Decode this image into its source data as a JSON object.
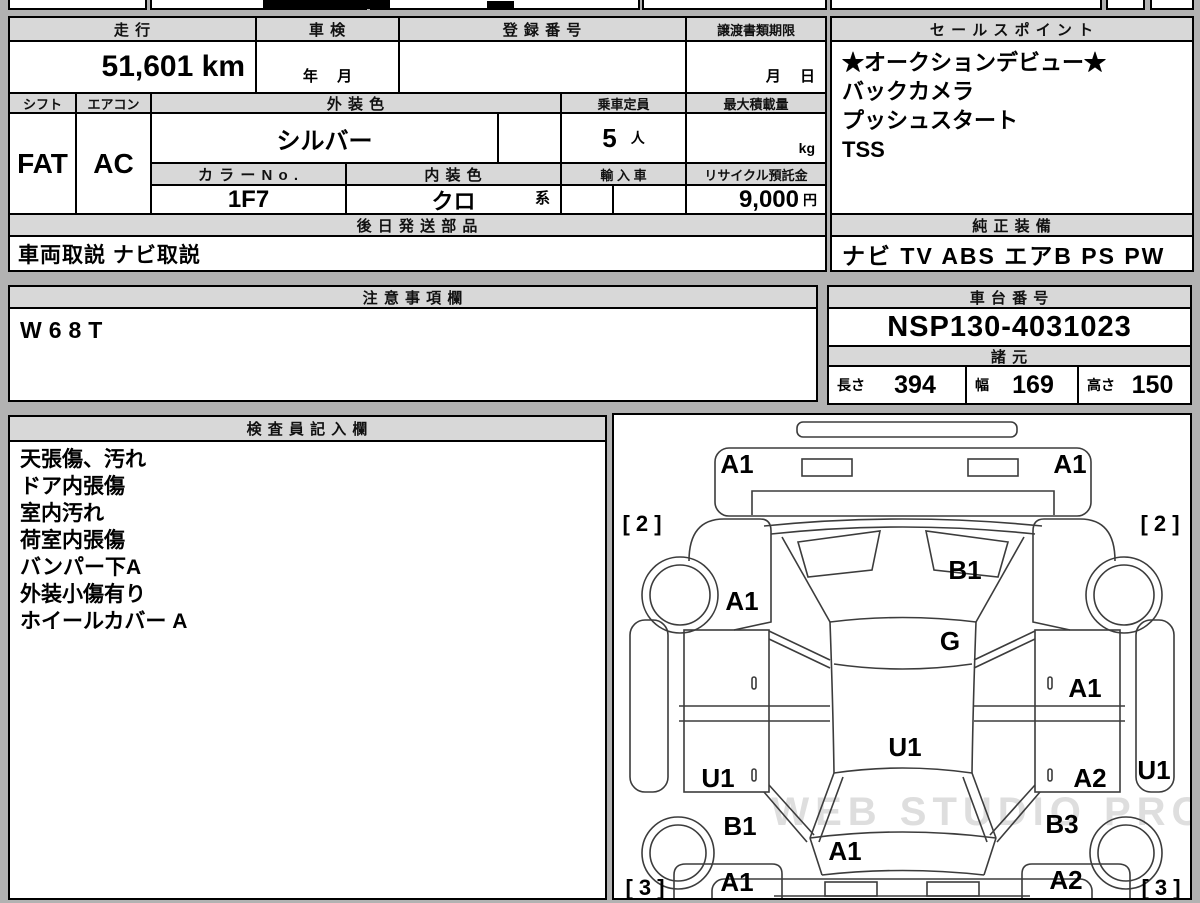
{
  "main_table": {
    "mileage_label": "走 行",
    "mileage_value": "51,601 km",
    "inspection_label": "車 検",
    "inspection_value": "年　 月",
    "registration_label": "登 録 番 号",
    "registration_value": "",
    "transfer_label": "譲渡書類期限",
    "transfer_value": "月　 日",
    "shift_label": "シフト",
    "shift_value": "FAT",
    "aircon_label": "エアコン",
    "aircon_value": "AC",
    "exterior_color_label": "外 装 色",
    "exterior_color_value": "シルバー",
    "capacity_label": "乗車定員",
    "capacity_value": "5",
    "capacity_unit": "人",
    "max_load_label": "最大積載量",
    "max_load_unit": "kg",
    "color_no_label": "カ ラ ー N o .",
    "color_no_value": "1F7",
    "interior_color_label": "内 装 色",
    "interior_color_value": "クロ",
    "interior_color_suffix": "系",
    "import_label": "輸 入 車",
    "recycle_label": "リサイクル預託金",
    "recycle_value": "9,000",
    "recycle_unit": "円",
    "later_parts_label": "後 日 発 送 部 品",
    "later_parts_value": "車両取説 ナビ取説"
  },
  "sales_points": {
    "label": "セ ー ル ス ポ イ ン ト",
    "items": [
      "★オークションデビュー★",
      "バックカメラ",
      "プッシュスタート",
      "TSS"
    ]
  },
  "genuine_equipment": {
    "label": "純 正 装 備",
    "value": "ナビ  TV  ABS  エアB  PS  PW"
  },
  "notes": {
    "label": "注 意 事 項 欄",
    "value": "W68T"
  },
  "chassis": {
    "label": "車 台 番 号",
    "value": "NSP130-4031023"
  },
  "specs": {
    "label": "諸 元",
    "length_label": "長さ",
    "length_value": "394",
    "width_label": "幅",
    "width_value": "169",
    "height_label": "高さ",
    "height_value": "150"
  },
  "inspector": {
    "label": "検 査 員 記 入 欄",
    "lines": [
      "天張傷、汚れ",
      "ドア内張傷",
      "室内汚れ",
      "荷室内張傷",
      "バンパー下A",
      "外装小傷有り",
      "ホイールカバー A"
    ]
  },
  "diagram": {
    "watermark": "WEB STUDIO PRO",
    "labels": [
      {
        "text": "A1",
        "x": 123,
        "y": 58
      },
      {
        "text": "A1",
        "x": 456,
        "y": 58
      },
      {
        "text": "[ 2 ]",
        "x": 28,
        "y": 116,
        "bracket": true
      },
      {
        "text": "[ 2 ]",
        "x": 546,
        "y": 116,
        "bracket": true
      },
      {
        "text": "A1",
        "x": 128,
        "y": 195
      },
      {
        "text": "B1",
        "x": 351,
        "y": 164
      },
      {
        "text": "G",
        "x": 336,
        "y": 235
      },
      {
        "text": "A1",
        "x": 471,
        "y": 282
      },
      {
        "text": "U1",
        "x": 291,
        "y": 341
      },
      {
        "text": "U1",
        "x": 104,
        "y": 372
      },
      {
        "text": "A2",
        "x": 476,
        "y": 372
      },
      {
        "text": "U1",
        "x": 540,
        "y": 364
      },
      {
        "text": "B1",
        "x": 126,
        "y": 420
      },
      {
        "text": "B3",
        "x": 448,
        "y": 418
      },
      {
        "text": "A1",
        "x": 231,
        "y": 445
      },
      {
        "text": "A1",
        "x": 123,
        "y": 476
      },
      {
        "text": "A2",
        "x": 452,
        "y": 474
      },
      {
        "text": "[ 3 ]",
        "x": 31,
        "y": 480,
        "bracket": true
      },
      {
        "text": "[ 3 ]",
        "x": 547,
        "y": 480,
        "bracket": true
      }
    ]
  }
}
